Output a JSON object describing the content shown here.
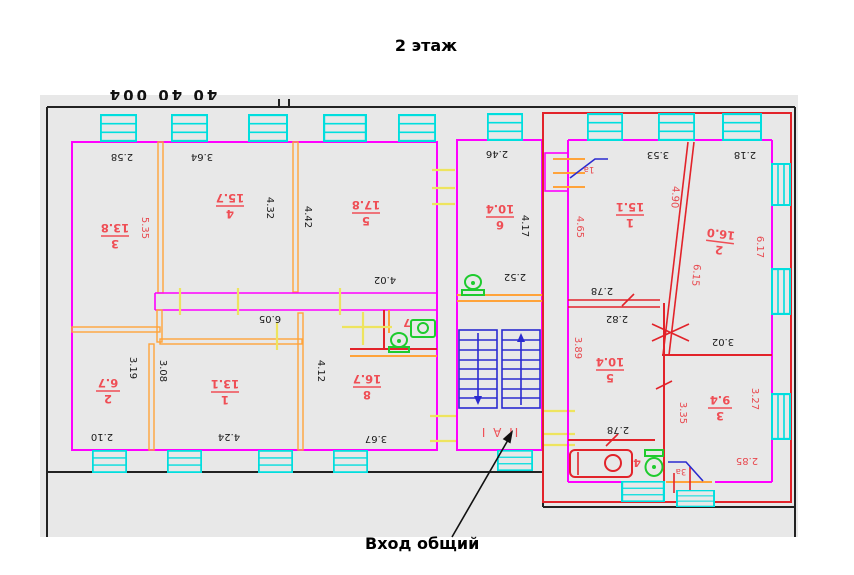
{
  "title": "2 этаж",
  "entrance_label": "Вход общий",
  "stair_zone_label": "II А I",
  "top_edge_fragment": "40 40 004",
  "rooms": {
    "l3": {
      "num": "3",
      "area": "13.8"
    },
    "l4": {
      "num": "4",
      "area": "15.7"
    },
    "l5": {
      "num": "5",
      "area": "17.8"
    },
    "l6": {
      "num": "6",
      "area": "10.4"
    },
    "l2": {
      "num": "2",
      "area": "6.7"
    },
    "l1": {
      "num": "1",
      "area": "13.1"
    },
    "l8": {
      "num": "8",
      "area": "16.7"
    },
    "r1": {
      "num": "1",
      "area": "15.1"
    },
    "r2": {
      "num": "2",
      "area": "16.0"
    },
    "r5": {
      "num": "5",
      "area": "10.4"
    },
    "r3": {
      "num": "3",
      "area": "9.4"
    }
  },
  "wc_labels": {
    "left": "7",
    "right": "4"
  },
  "door_labels": {
    "d1a": "1а",
    "d3a": "3а"
  },
  "dims": {
    "d258": "2.58",
    "d364": "3.64",
    "d432": "4.32",
    "d442": "4.42",
    "d402": "4.02",
    "d246": "2.46",
    "d417": "4.17",
    "d252": "2.52",
    "d605": "6.05",
    "d319": "3.19",
    "d308": "3.08",
    "d210": "2.10",
    "d424": "4.24",
    "d412": "4.12",
    "d367": "3.67",
    "d353": "3.53",
    "d218": "2.18",
    "d278a": "2.78",
    "d282": "2.82",
    "d302": "3.02",
    "d278b": "2.78",
    "d535": "5.35",
    "d465": "4.65",
    "d490": "4.90",
    "d617": "6.17",
    "d615": "6.15",
    "d389": "3.89",
    "d335": "3.35",
    "d327": "3.27",
    "d285": "2.85"
  },
  "colors": {
    "wall_magenta": "#ff00ff",
    "wall_orange": "#ffa33a",
    "wall_red": "#e2232a",
    "window_cyan": "#00dede",
    "stairs_blue": "#2a2ad0",
    "door_tick_yellow": "#eee45e",
    "label_red": "#ef4e55",
    "dim_black": "#1a1a1a",
    "scan_gray": "#e8e8e8",
    "sanitary_green": "#1ecb2e"
  }
}
